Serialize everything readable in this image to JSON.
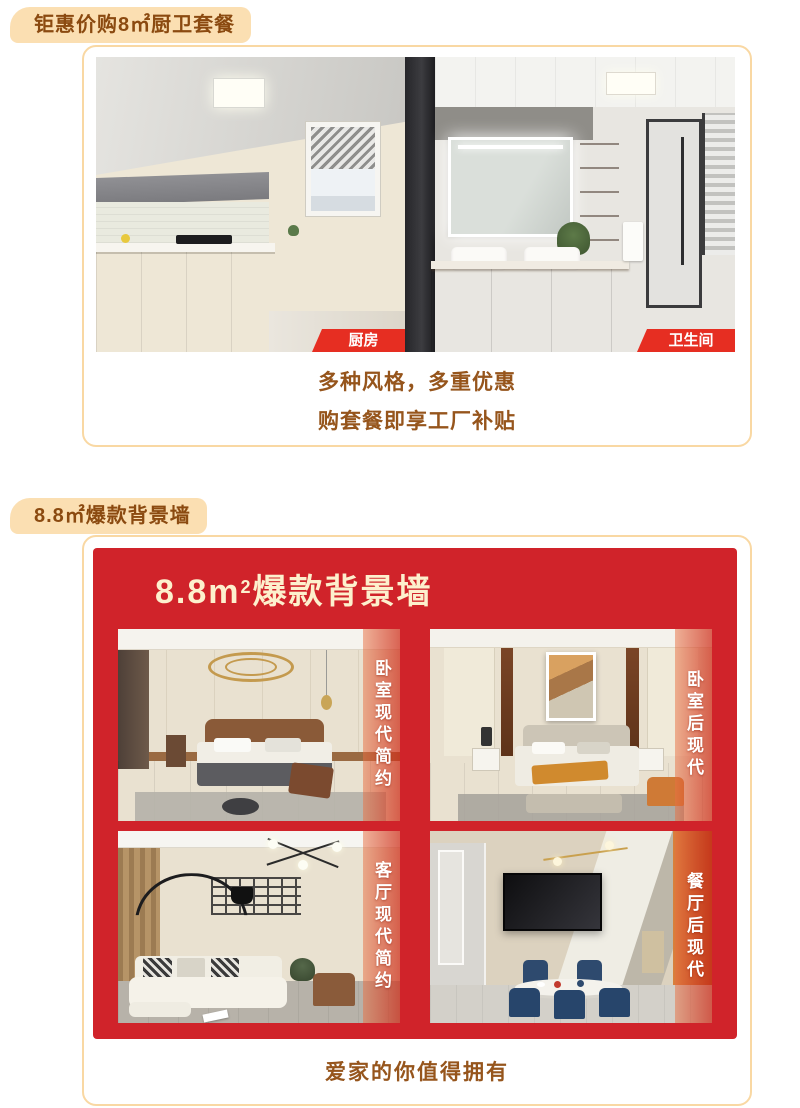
{
  "colors": {
    "badge_bg": "#fbdfb2",
    "badge_text": "#8b4a10",
    "panel_border": "#f9d8a3",
    "body_text": "#96551c",
    "ribbon_red": "#e62e22",
    "card_red": "#d0232a",
    "title_cream": "#fdf0cd"
  },
  "section1": {
    "badge": "钜惠价购8㎡厨卫套餐",
    "kitchen_label": "厨房",
    "bathroom_label": "卫生间",
    "slogan_line1": "多种风格，多重优惠",
    "slogan_line2": "购套餐即享工厂补贴"
  },
  "section2": {
    "badge": "8.8㎡爆款背景墙",
    "card_title": {
      "prefix": "8.8m",
      "sup": "2",
      "suffix": "爆款背景墙"
    },
    "rooms": [
      {
        "id": "bedroom-modern",
        "label": "卧室现代简约"
      },
      {
        "id": "bedroom-postmodern",
        "label": "卧室后现代"
      },
      {
        "id": "living-modern",
        "label": "客厅现代简约"
      },
      {
        "id": "dining-postmodern",
        "label": "餐厅后现代"
      }
    ],
    "footer": "爱家的你值得拥有"
  }
}
